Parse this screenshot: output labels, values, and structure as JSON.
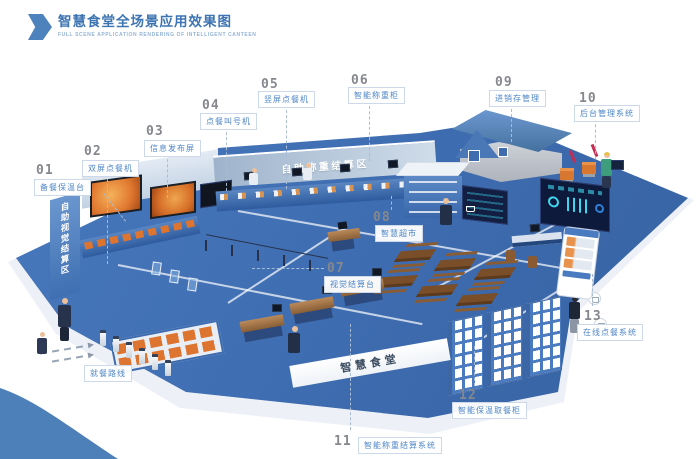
{
  "header": {
    "title": "智慧食堂全场景应用效果图",
    "subtitle": "FULL SCENE APPLICATION RENDERING OF INTELLIGENT CANTEEN"
  },
  "callouts": [
    {
      "num": "01",
      "label": "备餐保温台"
    },
    {
      "num": "02",
      "label": "双屏点餐机"
    },
    {
      "num": "03",
      "label": "信息发布屏"
    },
    {
      "num": "04",
      "label": "点餐叫号机"
    },
    {
      "num": "05",
      "label": "竖屏点餐机"
    },
    {
      "num": "06",
      "label": "智能称重柜"
    },
    {
      "num": "07",
      "label": "视觉结算台"
    },
    {
      "num": "08",
      "label": "智慧超市"
    },
    {
      "num": "09",
      "label": "进销存管理"
    },
    {
      "num": "10",
      "label": "后台管理系统"
    },
    {
      "num": "11",
      "label": "智能称重结算系统"
    },
    {
      "num": "12",
      "label": "智能保温取餐柜"
    },
    {
      "num": "13",
      "label": "在线点餐系统"
    }
  ],
  "scene_labels": {
    "left_pillar": "自助视觉结算区",
    "back_wall": "自助称重结算区",
    "floor": "智慧食堂",
    "route": "就餐路线"
  },
  "colors": {
    "accent": "#3d74b2",
    "callout_text": "#4e86c6",
    "floor": "#3e6cb0",
    "wave": "#4d80b9",
    "tray_orange": "#dd7430",
    "dashboard": "#131f42",
    "dashboard_glow": "#3fd6ee"
  }
}
